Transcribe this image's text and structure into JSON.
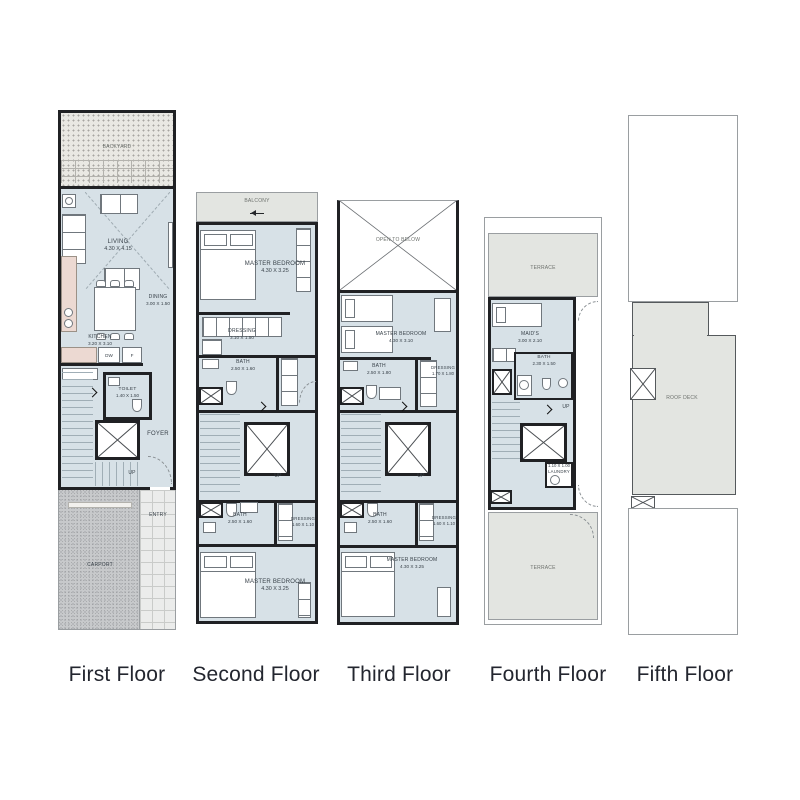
{
  "colors": {
    "wall": "#202124",
    "thin": "#9a9ea1",
    "int": "#d7e1e7",
    "ter": "#e3e5e1",
    "tread": "#a0aeb6",
    "furn": "#70777d",
    "label": "#39424a",
    "flabel": "#23262f",
    "arc": "#8a9094"
  },
  "floor_labels": [
    "First Floor",
    "Second Floor",
    "Third Floor",
    "Fourth Floor",
    "Fifth Floor"
  ],
  "floors": {
    "first": {
      "backyard": "BACKYARD",
      "living": {
        "name": "LIVING",
        "dims": "4.30 X 4.15"
      },
      "dining": {
        "name": "DINING",
        "dims": "3.00 X 1.50"
      },
      "kitchen": {
        "name": "KITCHEN",
        "dims": "3.20 X 3.10"
      },
      "dw": "DW",
      "fridge": "F",
      "toilet": {
        "name": "TOILET",
        "dims": "1.40 X 1.50"
      },
      "foyer": "FOYER",
      "up": "UP",
      "entry": "ENTRY",
      "carport": "CARPORT"
    },
    "second": {
      "balcony": "BALCONY",
      "master_top": {
        "name": "MASTER BEDROOM",
        "dims": "4.30 X 3.25"
      },
      "dressing_top": {
        "name": "DRESSING",
        "dims": "3.10 X 1.50"
      },
      "bath_top": {
        "name": "BATH",
        "dims": "2.50 X 1.60"
      },
      "up": "UP",
      "bath_bottom": {
        "name": "BATH",
        "dims": "2.50 X 1.60"
      },
      "dressing_bottom": {
        "name": "DRESSING",
        "dims": "1.60 X 1.10"
      },
      "master_bottom": {
        "name": "MASTER BEDROOM",
        "dims": "4.30 X 3.25"
      }
    },
    "third": {
      "open_to_below": "OPEN TO BELOW",
      "master_top": {
        "name": "MASTER BEDROOM",
        "dims": "4.30 X 3.10"
      },
      "bath_top": {
        "name": "BATH",
        "dims": "2.50 X 1.80"
      },
      "dressing_top": {
        "name": "DRESSING",
        "dims": "1.70 X 1.80"
      },
      "up": "UP",
      "bath_bottom": {
        "name": "BATH",
        "dims": "2.50 X 1.60"
      },
      "dressing_bottom": {
        "name": "DRESSING",
        "dims": "1.60 X 1.10"
      },
      "master_bottom": {
        "name": "MASTER BEDROOM",
        "dims": "4.30 X 3.25"
      }
    },
    "fourth": {
      "terrace_top": "TERRACE",
      "maids": {
        "name": "MAID'S",
        "dims": "3.00 X 2.10"
      },
      "bath": {
        "name": "BATH",
        "dims": "2.30 X 1.50"
      },
      "up": "UP",
      "laundry": {
        "name": "LAUNDRY",
        "dims": "1.10 X 1.00"
      },
      "terrace_bottom": "TERRACE"
    },
    "fifth": {
      "roof_deck": "ROOF DECK"
    }
  }
}
